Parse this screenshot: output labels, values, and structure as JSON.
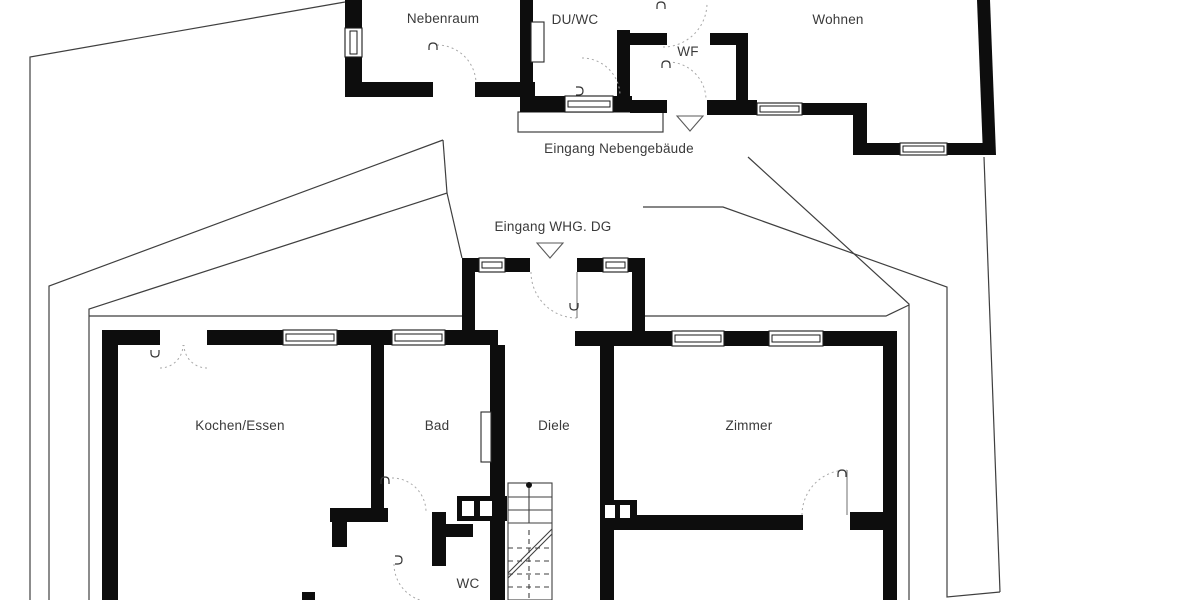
{
  "floorplan": {
    "upper_building": {
      "rooms": [
        {
          "id": "nebenraum",
          "label": "Nebenraum"
        },
        {
          "id": "duwc",
          "label": "DU/WC"
        },
        {
          "id": "wf",
          "label": "WF"
        },
        {
          "id": "wohnen",
          "label": "Wohnen"
        }
      ],
      "entrance_label": "Eingang Nebengebäude"
    },
    "lower_building": {
      "rooms": [
        {
          "id": "kochen_essen",
          "label": "Kochen/Essen"
        },
        {
          "id": "bad",
          "label": "Bad"
        },
        {
          "id": "diele",
          "label": "Diele"
        },
        {
          "id": "zimmer",
          "label": "Zimmer"
        },
        {
          "id": "wc",
          "label": "WC"
        }
      ],
      "entrance_label": "Eingang WHG. DG"
    },
    "colors": {
      "wall": "#0d0d0d",
      "outline": "#3f3f3f",
      "text": "#3a3a3a",
      "background": "#ffffff"
    }
  }
}
